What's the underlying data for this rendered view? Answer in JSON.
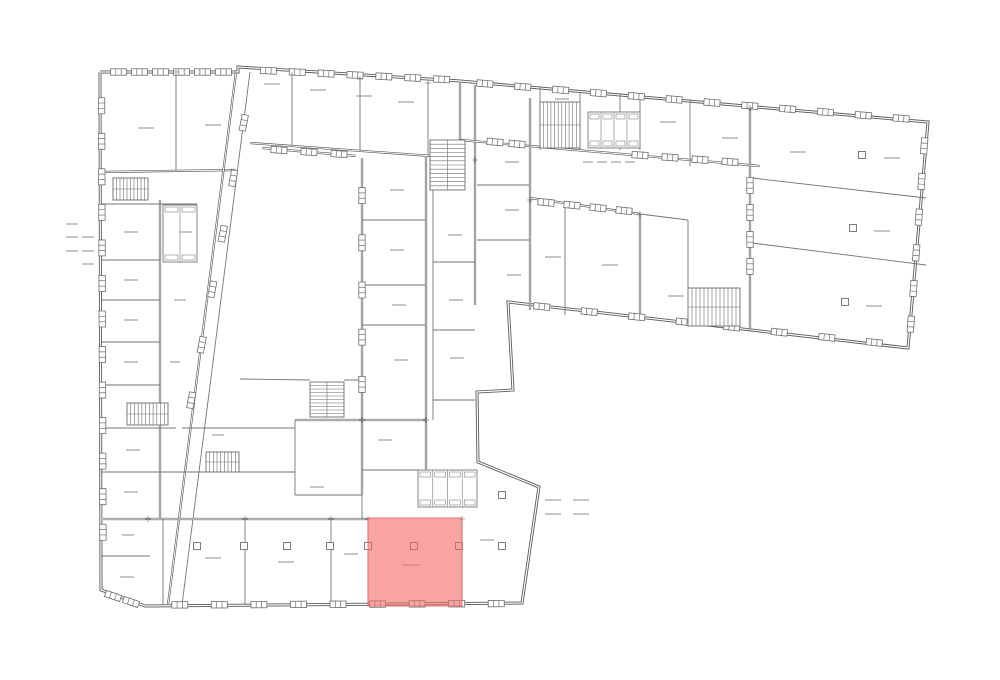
{
  "page": {
    "background": "#ffffff",
    "width": 1000,
    "height": 680
  },
  "colors": {
    "wall": "#595959",
    "thin": "#757575",
    "window": "#6f6f6f",
    "stair": "#6d6d6d",
    "fixture": "#787878",
    "label": "#979797",
    "tick": "#8d8d8d",
    "cross": "#808080",
    "highlight_fill": "#f56868",
    "highlight_fill_opacity": 0.6,
    "highlight_stroke": "#e26a6a",
    "highlight_stroke_opacity": 0.85
  },
  "floorplan": {
    "outline": [
      [
        100,
        72
      ],
      [
        238,
        72
      ],
      [
        238,
        67
      ],
      [
        460,
        81
      ],
      [
        928,
        122
      ],
      [
        908,
        348
      ],
      [
        508,
        302
      ],
      [
        513,
        390
      ],
      [
        477,
        392
      ],
      [
        478,
        462
      ],
      [
        539,
        487
      ],
      [
        522,
        603
      ],
      [
        145,
        606
      ],
      [
        101,
        590
      ],
      [
        100,
        72
      ]
    ],
    "walls": [
      [
        176,
        72,
        176,
        171,
        1
      ],
      [
        100,
        172,
        236,
        170,
        2
      ],
      [
        236,
        72,
        168,
        605,
        2
      ],
      [
        250,
        72,
        182,
        605,
        1
      ],
      [
        250,
        143,
        460,
        158,
        2
      ],
      [
        292,
        74,
        292,
        145,
        1
      ],
      [
        360,
        78,
        360,
        150,
        1
      ],
      [
        428,
        82,
        428,
        155,
        1
      ],
      [
        460,
        82,
        460,
        140,
        2
      ],
      [
        475,
        85,
        475,
        305,
        2
      ],
      [
        160,
        200,
        160,
        519,
        2
      ],
      [
        101,
        204,
        197,
        204,
        1
      ],
      [
        101,
        260,
        160,
        260,
        1
      ],
      [
        101,
        300,
        160,
        300,
        1
      ],
      [
        101,
        342,
        160,
        342,
        1
      ],
      [
        101,
        385,
        160,
        385,
        1
      ],
      [
        101,
        428,
        176,
        428,
        1
      ],
      [
        182,
        428,
        295,
        428,
        1
      ],
      [
        101,
        472,
        295,
        472,
        1
      ],
      [
        103,
        519,
        368,
        519,
        2
      ],
      [
        101,
        556,
        150,
        556,
        1
      ],
      [
        163,
        519,
        163,
        604,
        1
      ],
      [
        245,
        519,
        245,
        604,
        1
      ],
      [
        331,
        519,
        331,
        604,
        1
      ],
      [
        462,
        519,
        462,
        604,
        1
      ],
      [
        368,
        518,
        368,
        604,
        1
      ],
      [
        362,
        158,
        362,
        495,
        2
      ],
      [
        362,
        495,
        362,
        519,
        1
      ],
      [
        362,
        220,
        426,
        220,
        1
      ],
      [
        362,
        285,
        426,
        285,
        1
      ],
      [
        362,
        325,
        426,
        325,
        1
      ],
      [
        295,
        420,
        426,
        420,
        2
      ],
      [
        295,
        420,
        295,
        495,
        1
      ],
      [
        295,
        495,
        362,
        495,
        1
      ],
      [
        426,
        156,
        426,
        470,
        2
      ],
      [
        433,
        156,
        433,
        420,
        1
      ],
      [
        433,
        262,
        475,
        262,
        1
      ],
      [
        433,
        330,
        475,
        330,
        1
      ],
      [
        433,
        400,
        475,
        400,
        1
      ],
      [
        477,
        185,
        530,
        185,
        1
      ],
      [
        477,
        240,
        530,
        240,
        1
      ],
      [
        530,
        98,
        530,
        310,
        2
      ],
      [
        540,
        88,
        540,
        150,
        1
      ],
      [
        580,
        92,
        580,
        150,
        1
      ],
      [
        620,
        95,
        620,
        150,
        1
      ],
      [
        640,
        97,
        640,
        150,
        1
      ],
      [
        690,
        101,
        690,
        166,
        1
      ],
      [
        750,
        107,
        750,
        330,
        2
      ],
      [
        460,
        140,
        760,
        166,
        2
      ],
      [
        752,
        178,
        926,
        198,
        1
      ],
      [
        752,
        243,
        926,
        265,
        1
      ],
      [
        530,
        198,
        640,
        214,
        2
      ],
      [
        640,
        214,
        688,
        220,
        1
      ],
      [
        688,
        220,
        688,
        288,
        1
      ],
      [
        565,
        205,
        565,
        315,
        1
      ],
      [
        640,
        214,
        640,
        318,
        2
      ],
      [
        362,
        470,
        418,
        470,
        1
      ],
      [
        262,
        148,
        356,
        156,
        2
      ],
      [
        240,
        379,
        310,
        380,
        1
      ],
      [
        344,
        380,
        362,
        380,
        1
      ]
    ],
    "windows": [
      [
        101.5,
        88,
        103,
        550,
        13
      ],
      [
        108,
        72,
        234,
        72,
        6
      ],
      [
        254,
        70,
        456,
        80,
        7
      ],
      [
        466,
        82,
        920,
        120,
        12
      ],
      [
        925.5,
        128,
        909.5,
        342,
        6
      ],
      [
        898,
        345,
        518,
        304,
        8
      ],
      [
        160,
        605,
        516,
        603.5,
        9
      ],
      [
        104,
        593,
        140,
        605,
        2
      ],
      [
        362,
        172,
        362,
        408,
        5
      ],
      [
        264,
        149,
        354,
        155,
        3
      ],
      [
        625,
        154,
        745,
        163,
        4
      ],
      [
        484,
        141,
        528,
        145,
        2
      ],
      [
        533,
        201,
        637,
        212,
        4
      ],
      [
        750,
        172,
        750,
        280,
        4
      ],
      [
        249,
        95,
        186,
        428,
        6
      ]
    ],
    "stairs": [
      [
        113,
        178,
        35,
        22,
        "h",
        10
      ],
      [
        127,
        403,
        41,
        22,
        "h",
        11
      ],
      [
        206,
        452,
        33,
        20,
        "h",
        9
      ],
      [
        310,
        382,
        34,
        35,
        "v",
        10
      ],
      [
        540,
        102,
        40,
        46,
        "h",
        11
      ],
      [
        688,
        288,
        52,
        38,
        "h",
        13
      ],
      [
        430,
        140,
        35,
        50,
        "v",
        12
      ]
    ],
    "wcs": [
      [
        163,
        205,
        34,
        57,
        2
      ],
      [
        588,
        112,
        52,
        36,
        4
      ],
      [
        418,
        470,
        59,
        37,
        4
      ]
    ],
    "squares": [
      [
        197,
        546
      ],
      [
        244,
        546
      ],
      [
        287,
        546
      ],
      [
        330,
        546
      ],
      [
        368,
        546
      ],
      [
        414,
        546
      ],
      [
        459,
        546
      ],
      [
        502,
        546
      ],
      [
        502,
        495
      ],
      [
        862,
        155
      ],
      [
        853,
        228
      ],
      [
        845,
        302
      ]
    ],
    "labels": [
      [
        138,
        128,
        16
      ],
      [
        205,
        125,
        16
      ],
      [
        264,
        84,
        16
      ],
      [
        310,
        90,
        16
      ],
      [
        356,
        96,
        16
      ],
      [
        398,
        102,
        16
      ],
      [
        555,
        99,
        14
      ],
      [
        660,
        122,
        16
      ],
      [
        722,
        138,
        16
      ],
      [
        790,
        152,
        16
      ],
      [
        884,
        158,
        16
      ],
      [
        874,
        231,
        16
      ],
      [
        866,
        306,
        16
      ],
      [
        545,
        257,
        16
      ],
      [
        602,
        265,
        16
      ],
      [
        668,
        296,
        16
      ],
      [
        583,
        162,
        10
      ],
      [
        597,
        162,
        10
      ],
      [
        611,
        162,
        10
      ],
      [
        625,
        162,
        10
      ],
      [
        505,
        162,
        14
      ],
      [
        505,
        210,
        14
      ],
      [
        507,
        275,
        14
      ],
      [
        448,
        235,
        14
      ],
      [
        449,
        300,
        14
      ],
      [
        450,
        358,
        14
      ],
      [
        390,
        190,
        14
      ],
      [
        390,
        250,
        14
      ],
      [
        392,
        305,
        14
      ],
      [
        394,
        360,
        14
      ],
      [
        378,
        440,
        14
      ],
      [
        310,
        487,
        14
      ],
      [
        124,
        232,
        14
      ],
      [
        124,
        280,
        14
      ],
      [
        124,
        320,
        14
      ],
      [
        124,
        362,
        14
      ],
      [
        126,
        450,
        14
      ],
      [
        124,
        492,
        14
      ],
      [
        122,
        535,
        12
      ],
      [
        120,
        577,
        14
      ],
      [
        180,
        232,
        12
      ],
      [
        174,
        300,
        12
      ],
      [
        170,
        362,
        10
      ],
      [
        212,
        435,
        12
      ],
      [
        205,
        558,
        16
      ],
      [
        278,
        562,
        16
      ],
      [
        344,
        554,
        14
      ],
      [
        480,
        540,
        14
      ],
      [
        402,
        565,
        18
      ]
    ],
    "ticks": [
      [
        66,
        224,
        12
      ],
      [
        66,
        237,
        12
      ],
      [
        82,
        237,
        12
      ],
      [
        66,
        251,
        12
      ],
      [
        82,
        251,
        12
      ],
      [
        82,
        264,
        12
      ],
      [
        545,
        500,
        16
      ],
      [
        573,
        500,
        16
      ],
      [
        545,
        514,
        16
      ],
      [
        573,
        514,
        16
      ]
    ],
    "crosses": [
      [
        176,
        72
      ],
      [
        292,
        75
      ],
      [
        360,
        79
      ],
      [
        428,
        83
      ],
      [
        540,
        89
      ],
      [
        620,
        96
      ],
      [
        690,
        102
      ],
      [
        750,
        108
      ],
      [
        245,
        519
      ],
      [
        331,
        519
      ],
      [
        368,
        519
      ],
      [
        462,
        519
      ],
      [
        362,
        420
      ],
      [
        426,
        420
      ],
      [
        530,
        200
      ],
      [
        640,
        214
      ],
      [
        475,
        160
      ],
      [
        148,
        519
      ]
    ],
    "highlight": {
      "x": 368,
      "y": 518,
      "w": 94,
      "h": 88
    }
  }
}
